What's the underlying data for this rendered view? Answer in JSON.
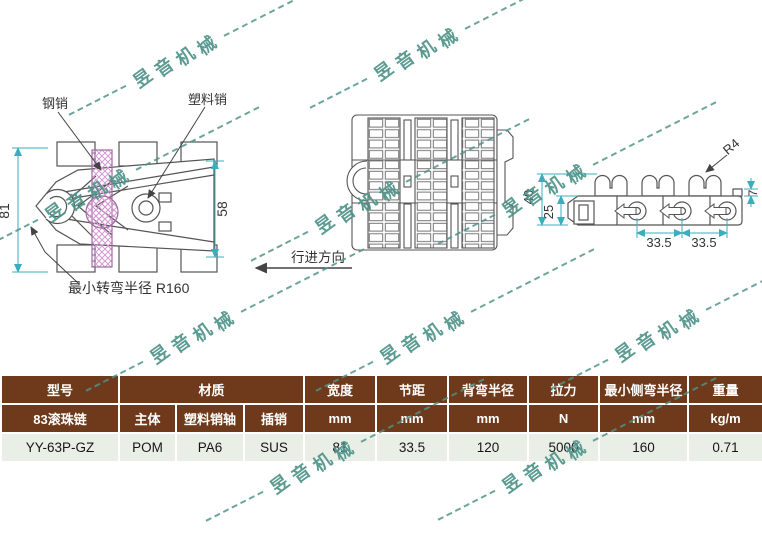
{
  "colors": {
    "table_header_bg": "#6f3a1b",
    "table_value_bg": "#e9efe7",
    "watermark": "#4f9389",
    "dimension_lines": "#3aaebd",
    "hatch_pink": "#d49ad0",
    "drawing_lines": "#555555"
  },
  "watermark": {
    "text": "昱音机械"
  },
  "front_view": {
    "steel_pin_label": "钢销",
    "plastic_pin_label": "塑料销",
    "outer_height": "81",
    "inner_height": "58",
    "min_turn_note": "最小转弯半径 R160"
  },
  "top_view": {
    "direction_label": "行进方向"
  },
  "side_view": {
    "total_height": "40",
    "link_height": "25",
    "radius_label": "R4",
    "tab_height": "7",
    "pitch_left": "33.5",
    "pitch_right": "33.5"
  },
  "table": {
    "header_row": [
      "型号",
      "材质",
      "宽度",
      "节距",
      "背弯半径",
      "拉力",
      "最小侧弯半径",
      "重量"
    ],
    "sub_row": [
      "83滚珠链",
      "主体",
      "塑料销轴",
      "插销",
      "mm",
      "mm",
      "mm",
      "N",
      "mm",
      "kg/m"
    ],
    "value_row": [
      "YY-63P-GZ",
      "POM",
      "PA6",
      "SUS",
      "81",
      "33.5",
      "120",
      "5000",
      "160",
      "0.71"
    ]
  }
}
